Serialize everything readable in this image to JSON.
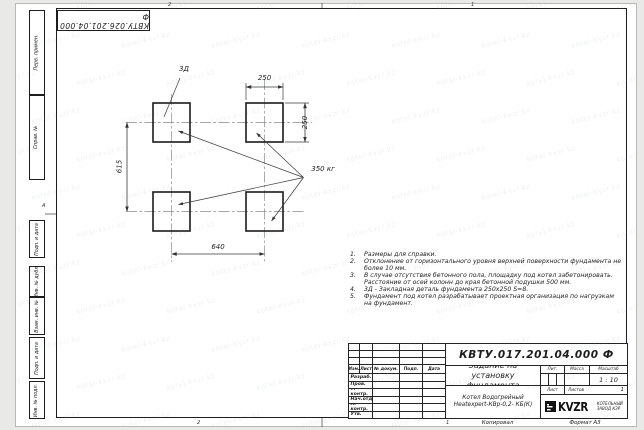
{
  "sheet": {
    "top_stamp": "КВТУ.026.201.04.000 Ф",
    "watermark": "kotel-kvzr.kz",
    "zones": {
      "top_left": "2",
      "top_right": "1",
      "bottom_left": "2",
      "bottom_right": "1",
      "left_row": "А"
    },
    "footer": {
      "copied": "Копировал",
      "format": "Формат А3"
    }
  },
  "margin_boxes": [
    "Перв. примен.",
    "Справ. №",
    "Подп. и дата",
    "Инв. № дубл.",
    "Взам. инв. №",
    "Подп. и дата",
    "Инв. № подл."
  ],
  "drawing": {
    "embed_label": "3Д",
    "load_label": "350 кг",
    "dim_pad_width": "250",
    "dim_pad_height": "250",
    "dim_span_vertical": "615",
    "dim_span_horizontal": "640"
  },
  "notes": [
    {
      "num": "1.",
      "text": "Размеры для справки."
    },
    {
      "num": "2.",
      "text": "Отклонение от горизонтального уровня верхней поверхности фундамента не более 10 мм."
    },
    {
      "num": "3.",
      "text": "В случае отсутствия бетонного пола, площадку под котел забетонировать. Расстояние от осей колонн до края бетонной подушки 500 мм."
    },
    {
      "num": "4.",
      "text": "3Д - Закладная деталь фундамента 250х250 S=8."
    },
    {
      "num": "5.",
      "text": "Фундамент под котел разрабатывает проектная организация по нагрузкам на фундамент."
    }
  ],
  "title_block": {
    "doc_number": "КВТУ.017.201.04.000 Ф",
    "title": "Задание на установку фундамента",
    "product": {
      "line1": "Котел Водогрейный",
      "line2": "Heatexpert-КВр-0,2- КБ(К)"
    },
    "header": {
      "izm": "Изм.",
      "list": "Лист",
      "doc": "№ докум.",
      "podp": "Подп.",
      "data": "Дата"
    },
    "rows": [
      "Разраб.",
      "Пров.",
      "Т. контр.",
      "Нач.отд.",
      "Н. контр.",
      "Утв."
    ],
    "lit_label": "Лит.",
    "mass_label": "Масса",
    "scale_label": "Масштаб",
    "scale_value": "1 : 10",
    "sheet_label": "Лист",
    "sheets_label": "Листов",
    "sheets_value": "1",
    "logo": {
      "word": "KVZR",
      "sub1": "КОТЕЛЬНЫЙ",
      "sub2": "ЗАВОД КЗР"
    }
  }
}
